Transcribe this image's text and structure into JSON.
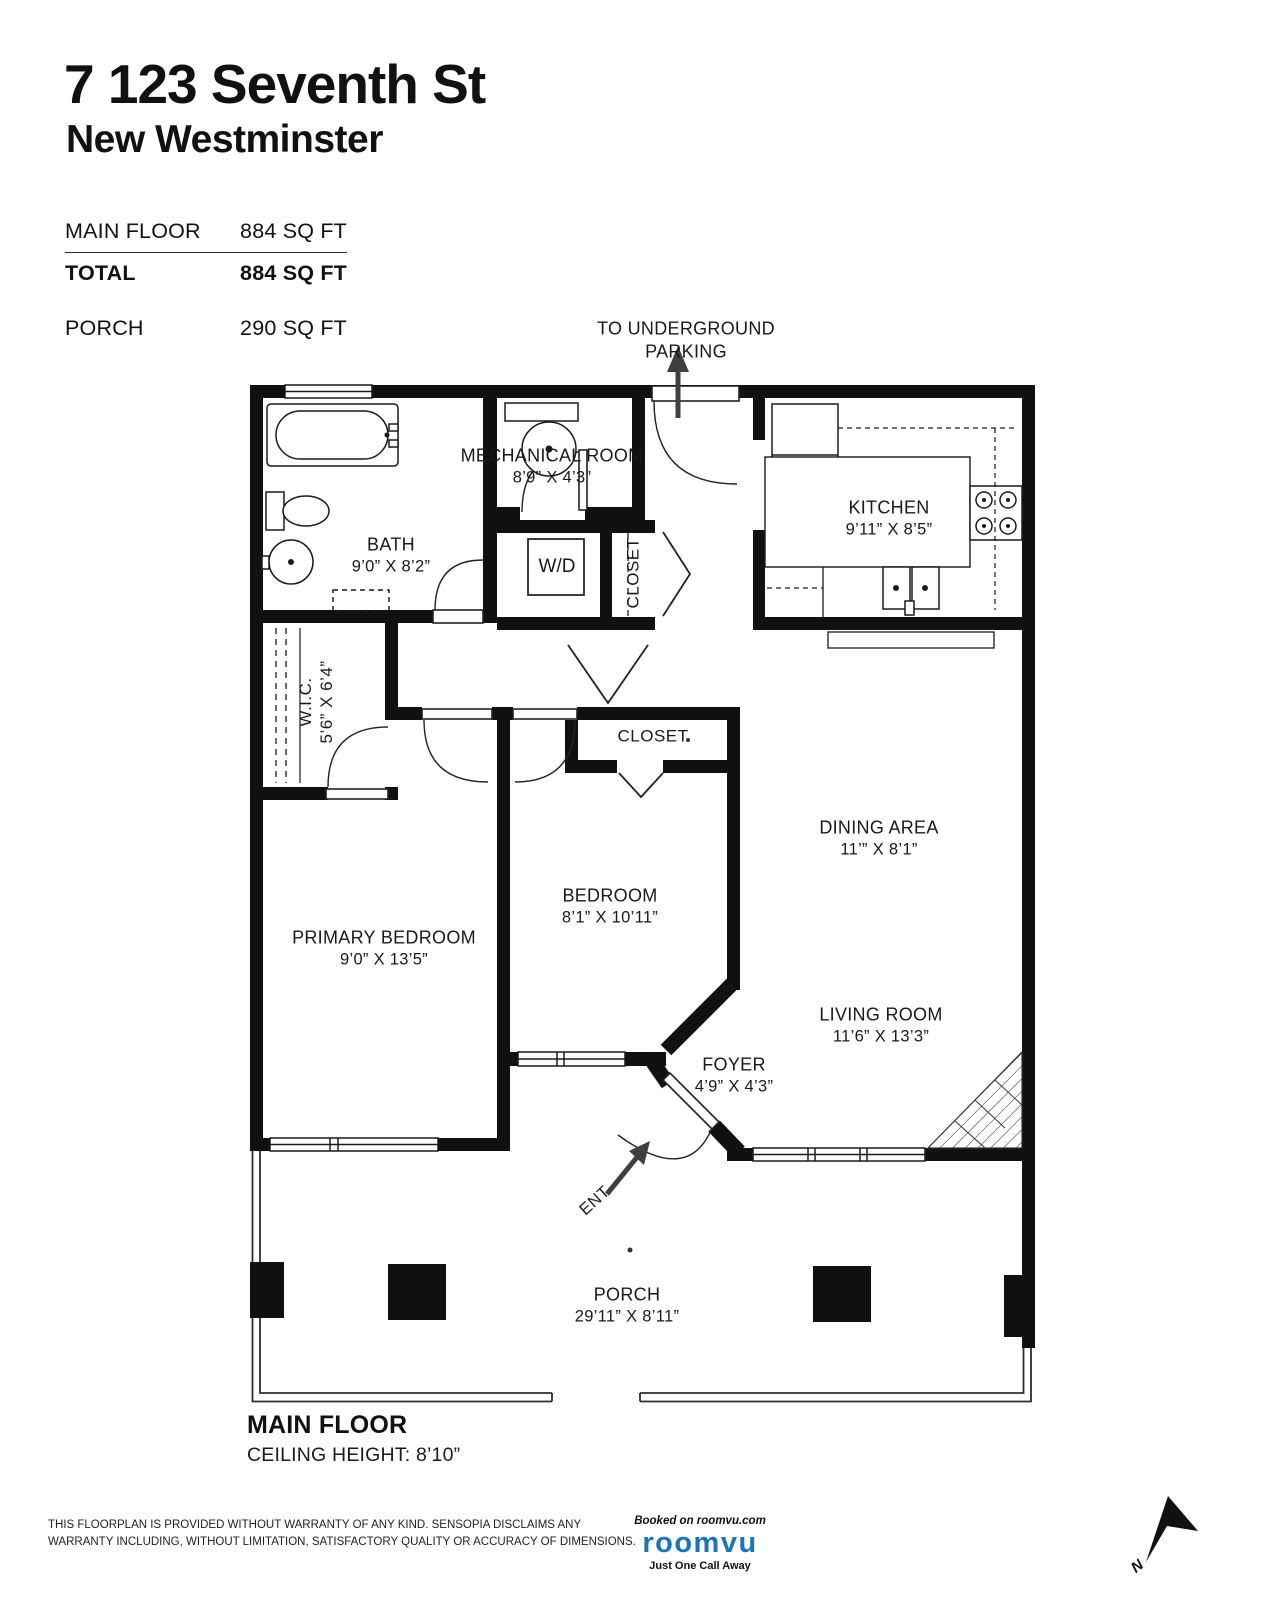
{
  "header": {
    "address": "7 123 Seventh St",
    "city": "New Westminster"
  },
  "areas": {
    "main_floor_label": "MAIN FLOOR",
    "main_floor_value": "884 SQ FT",
    "total_label": "TOTAL",
    "total_value": "884 SQ FT",
    "porch_label": "PORCH",
    "porch_value": "290 SQ FT"
  },
  "plan": {
    "annotations": {
      "parking_line1": "TO UNDERGROUND",
      "parking_line2": "PARKING",
      "entry": "ENT",
      "washer_dryer": "W/D",
      "hall_closet": "CLOSET",
      "bedroom_closet": "CLOSET",
      "wic_name": "W.I.C.",
      "wic_dims": "5’6” X 6’4”"
    },
    "rooms": {
      "mechanical": {
        "name": "MECHANICAL ROOM",
        "dims": "8’9” X 4’3”"
      },
      "bath": {
        "name": "BATH",
        "dims": "9’0” X 8’2”"
      },
      "kitchen": {
        "name": "KITCHEN",
        "dims": "9’11” X 8’5”"
      },
      "dining": {
        "name": "DINING AREA",
        "dims": "11’” X 8’1”"
      },
      "bedroom": {
        "name": "BEDROOM",
        "dims": "8’1” X 10’11”"
      },
      "primary": {
        "name": "PRIMARY BEDROOM",
        "dims": "9’0” X 13’5”"
      },
      "living": {
        "name": "LIVING ROOM",
        "dims": "11’6” X 13’3”"
      },
      "foyer": {
        "name": "FOYER",
        "dims": "4’9” X 4’3”"
      },
      "porch": {
        "name": "PORCH",
        "dims": "29’11” X 8’11”"
      }
    }
  },
  "footer": {
    "floor_name": "MAIN FLOOR",
    "ceiling_height": "CEILING HEIGHT: 8’10”",
    "disclaimer": "THIS FLOORPLAN IS PROVIDED WITHOUT WARRANTY OF ANY KIND. SENSOPIA DISCLAIMS ANY WARRANTY INCLUDING, WITHOUT LIMITATION, SATISFACTORY QUALITY OR ACCURACY OF DIMENSIONS.",
    "compass_label": "N"
  },
  "branding": {
    "booked": "Booked on roomvu.com",
    "logo": "roomvu",
    "tagline": "Just One Call Away",
    "logo_color": "#1b74b8"
  }
}
